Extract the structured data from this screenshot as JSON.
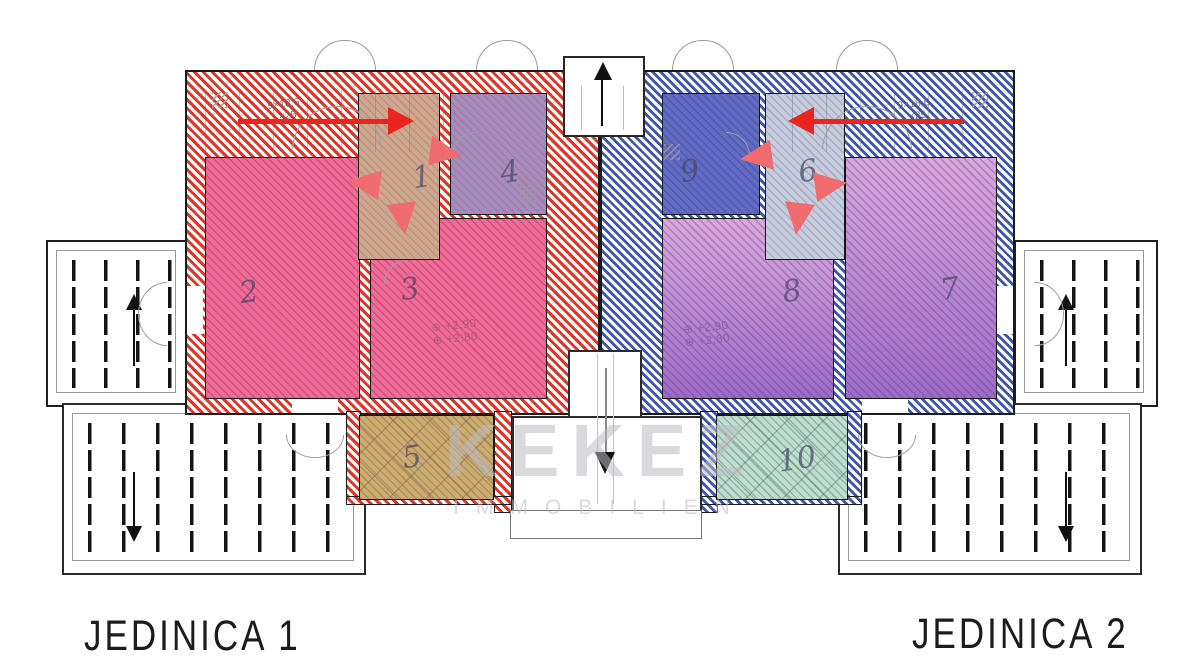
{
  "watermark": {
    "brand": "KEKEZ",
    "brand_sub": "IMMOBILIEN"
  },
  "level_symbol": "⊕",
  "units": [
    {
      "label": "JEDINICA 1",
      "accent": "#e13427",
      "level_upper": "+2,90",
      "level_lower": "+2,80",
      "stair_note_1": "9×18,6",
      "stair_note_2": "×25",
      "entrance_arrow": "right"
    },
    {
      "label": "JEDINICA 2",
      "accent": "#3c55ae",
      "level_upper": "+2,90",
      "level_lower": "+2,80",
      "stair_note_1": "9×18,6",
      "stair_note_2": "×25",
      "entrance_arrow": "left"
    }
  ],
  "rooms": [
    {
      "number": "1",
      "fill": "#c9ab92"
    },
    {
      "number": "2",
      "fill": "#ea6f9c"
    },
    {
      "number": "3",
      "fill": "#ea6f9c"
    },
    {
      "number": "4",
      "fill": "#a08fc0"
    },
    {
      "number": "5",
      "fill": "#c4b072"
    },
    {
      "number": "6",
      "fill": "#c9cdda"
    },
    {
      "number": "7",
      "fill": "#aa7cc8"
    },
    {
      "number": "8",
      "fill": "#aa7cc8"
    },
    {
      "number": "9",
      "fill": "#636cc0"
    },
    {
      "number": "10",
      "fill": "#bfe0c6"
    }
  ],
  "arrows": {
    "big_red": "#e8261f",
    "salmon": "#ef6b6e",
    "black": "#111111",
    "vestibule_direction": "up",
    "stairwell_direction": "down",
    "top_terraces_direction": "up",
    "bottom_terraces_direction": "down"
  }
}
